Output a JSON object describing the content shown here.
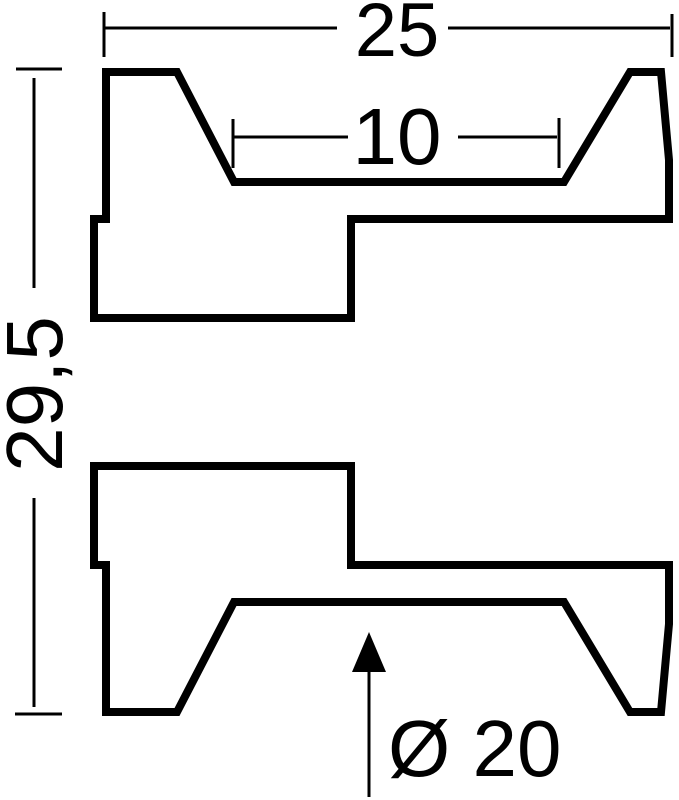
{
  "colors": {
    "background": "#ffffff",
    "line": "#000000"
  },
  "drawing": {
    "type": "technical-cross-section",
    "dimension_labels": {
      "overall_width": "25",
      "groove_width": "10",
      "total_height": "29,5",
      "groove_diameter": "Ø 20"
    }
  }
}
